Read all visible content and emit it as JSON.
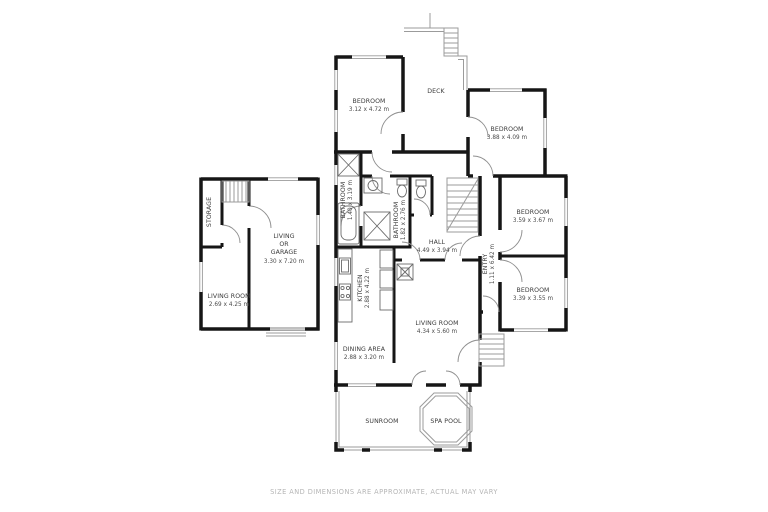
{
  "footer": {
    "disclaimer": "SIZE AND DIMENSIONS ARE APPROXIMATE, ACTUAL MAY VARY"
  },
  "colors": {
    "wall": "#161616",
    "thin_line": "#9b9b9b",
    "label": "#3a3a3a",
    "footer_text": "#b5b5b5",
    "background": "#ffffff"
  },
  "rooms": {
    "bedroom_top_left": {
      "name": "BEDROOM",
      "dims": "3.12 x 4.72 m"
    },
    "deck": {
      "name": "DECK"
    },
    "bedroom_top_right": {
      "name": "BEDROOM",
      "dims": "3.88 x 4.09 m"
    },
    "bedroom_mid_right": {
      "name": "BEDROOM",
      "dims": "3.59 x 3.67 m"
    },
    "bedroom_bottom_right": {
      "name": "BEDROOM",
      "dims": "3.39 x 3.55 m"
    },
    "entry": {
      "name": "ENTRY",
      "dims": "1.11 x 6.42 m"
    },
    "hall": {
      "name": "HALL",
      "dims": "4.49 x 3.94 m"
    },
    "bathroom_small": {
      "name": "BATHROOM",
      "dims": "1.40 x 3.19 m"
    },
    "bathroom_main": {
      "name": "BATHROOM",
      "dims": "1.82 x 2.76 m"
    },
    "kitchen": {
      "name": "KITCHEN",
      "dims": "2.88 x 4.22 m"
    },
    "dining_area": {
      "name": "DINING AREA",
      "dims": "2.88 x 3.20 m"
    },
    "living_room_main": {
      "name": "LIVING ROOM",
      "dims": "4.34 x 5.60 m"
    },
    "sunroom": {
      "name": "SUNROOM"
    },
    "spa_pool": {
      "name": "SPA POOL"
    },
    "storage": {
      "name": "STORAGE"
    },
    "living_or_garage": {
      "lines": [
        "LIVING",
        "OR",
        "GARAGE"
      ],
      "dims": "3.30 x 7.20 m"
    },
    "living_room_left": {
      "name": "LIVING ROOM",
      "dims": "2.69 x 4.25 m"
    }
  }
}
